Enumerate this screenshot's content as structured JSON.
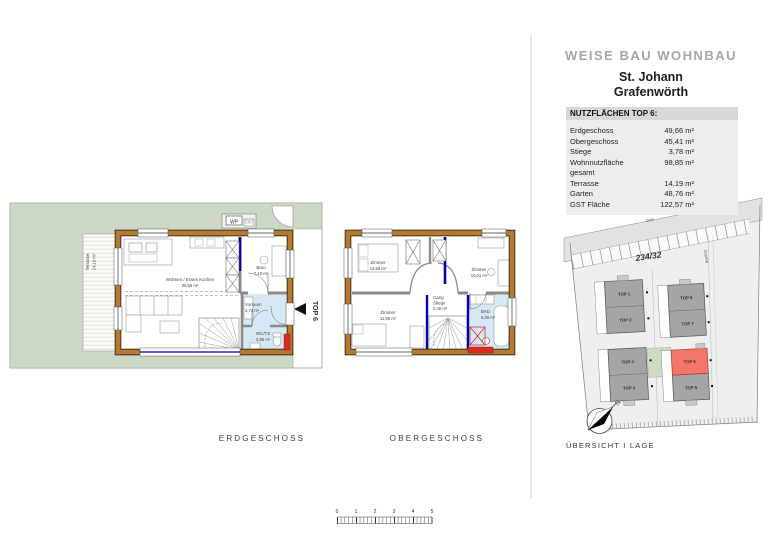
{
  "colors": {
    "garden_green": "#cdd7c5",
    "wall_brown": "#b6792d",
    "accent_blue": "#0000b0",
    "wet_room_blue": "#d6e8f4",
    "entrance_red": "#d92b21",
    "highlight_red": "#f4756a",
    "company_gray": "#a6a6a6"
  },
  "panel": {
    "company": "WEISE BAU WOHNBAU",
    "project_line1": "St. Johann",
    "project_line2": "Grafenwörth",
    "table": {
      "title": "NUTZFLÄCHEN TOP 6:",
      "rows": [
        {
          "label": "Erdgeschoss",
          "value": "49,66 m²"
        },
        {
          "label": "Obergeschoss",
          "value": "45,41 m²"
        },
        {
          "label": "Stiege",
          "value": "3,78 m²"
        },
        {
          "label": "Wohnnutzfläche gesamt",
          "value": "98,85 m²"
        },
        {
          "label": "Terrasse",
          "value": "14,19 m²"
        },
        {
          "label": "Garten",
          "value": "48,76 m²"
        },
        {
          "label": "GST Fläche",
          "value": "122,57 m²"
        }
      ]
    }
  },
  "erdgeschoss": {
    "caption": "ERDGESCHOSS",
    "terrace": {
      "name": "Terrasse",
      "area": "14,19 m²"
    },
    "wp_label": "WP",
    "unit_marker": "TOP 6",
    "rooms": [
      {
        "name": "Wohnen / Essen Kochen",
        "area": "35,56 m²"
      },
      {
        "name": "Büro",
        "area": "7,10 m²"
      },
      {
        "name": "Vorraum",
        "area": "3,74 m²"
      },
      {
        "name": "WC/TS",
        "area": "2,86 m²"
      }
    ]
  },
  "obergeschoss": {
    "caption": "OBERGESCHOSS",
    "rooms": [
      {
        "name": "Zimmer",
        "area": "14,58 m²"
      },
      {
        "name": "Zimmer",
        "area": "10,01 m²"
      },
      {
        "name": "Zimmer",
        "area": "11,65 m²"
      },
      {
        "name": "Gang",
        "name2": "Stiege",
        "area": "2,48 m²"
      },
      {
        "name": "BAD",
        "area": "6,09 m²"
      }
    ]
  },
  "siteplan": {
    "caption": "ÜBERSICHT I LAGE",
    "parcel_number": "234/32",
    "street_label": "Zeile",
    "access_label": "Zugang",
    "compass_north": "N",
    "buildings": [
      {
        "label": "TOP 1",
        "highlighted": false
      },
      {
        "label": "TOP 2",
        "highlighted": false
      },
      {
        "label": "TOP 3",
        "highlighted": false
      },
      {
        "label": "TOP 4",
        "highlighted": false
      },
      {
        "label": "TOP 8",
        "highlighted": false
      },
      {
        "label": "TOP 7",
        "highlighted": false
      },
      {
        "label": "TOP 6",
        "highlighted": true
      },
      {
        "label": "TOP 5",
        "highlighted": false
      }
    ]
  },
  "scalebar": {
    "ticks": [
      "0",
      "1",
      "2",
      "3",
      "4",
      "5"
    ]
  }
}
